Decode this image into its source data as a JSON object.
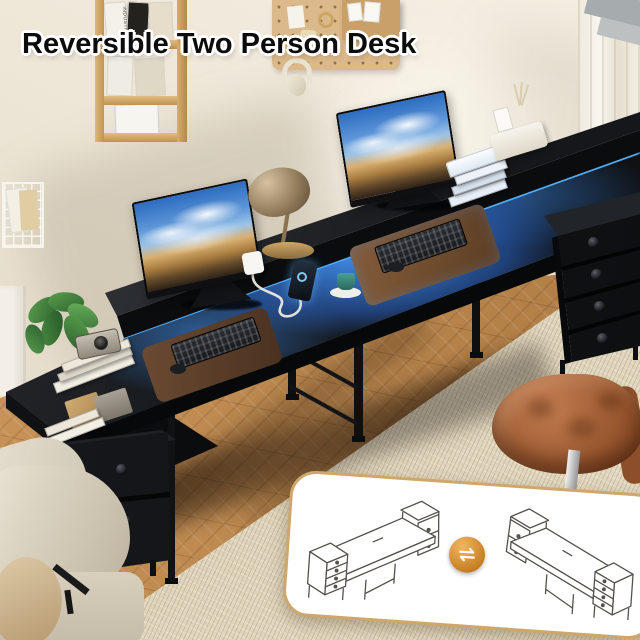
{
  "title": "Reversible Two Person Desk",
  "wall_shelf": {
    "magazine_spine_text": "INDUSTRY"
  },
  "colors": {
    "led_glow": "#4aa4ff",
    "desk_black": "#141619",
    "wall": "#ece4d4",
    "floor_wood": "#bd8a54",
    "rug": "#dcd2ba",
    "chair_leather": "#a9663c",
    "sofa": "#d8cfbf",
    "panel_border": "#cfa76b",
    "swap_icon_orange": "#d1913f",
    "cup_teal": "#3f8f86",
    "lamp_shade": "#b59a6e"
  },
  "scene_objects": [
    "two monitors with landscape wallpaper",
    "LED strip lighting",
    "brass desk lamp",
    "smartphone on stand",
    "power adapter with cable",
    "teal cup on saucer",
    "two keyboards on leather desk mats",
    "stacked books",
    "reed diffuser tray",
    "potted plant",
    "vintage camera on books",
    "4-drawer fabric dresser",
    "2-drawer fabric dresser",
    "leather office chair",
    "beige sofa with pillow",
    "wall magazine rack",
    "pegboard",
    "corkboard",
    "headphones",
    "wire basket",
    "curtain"
  ],
  "inset": {
    "variants": [
      "drawers-on-left configuration",
      "drawers-on-right configuration"
    ],
    "icon": "swap-arrows"
  }
}
